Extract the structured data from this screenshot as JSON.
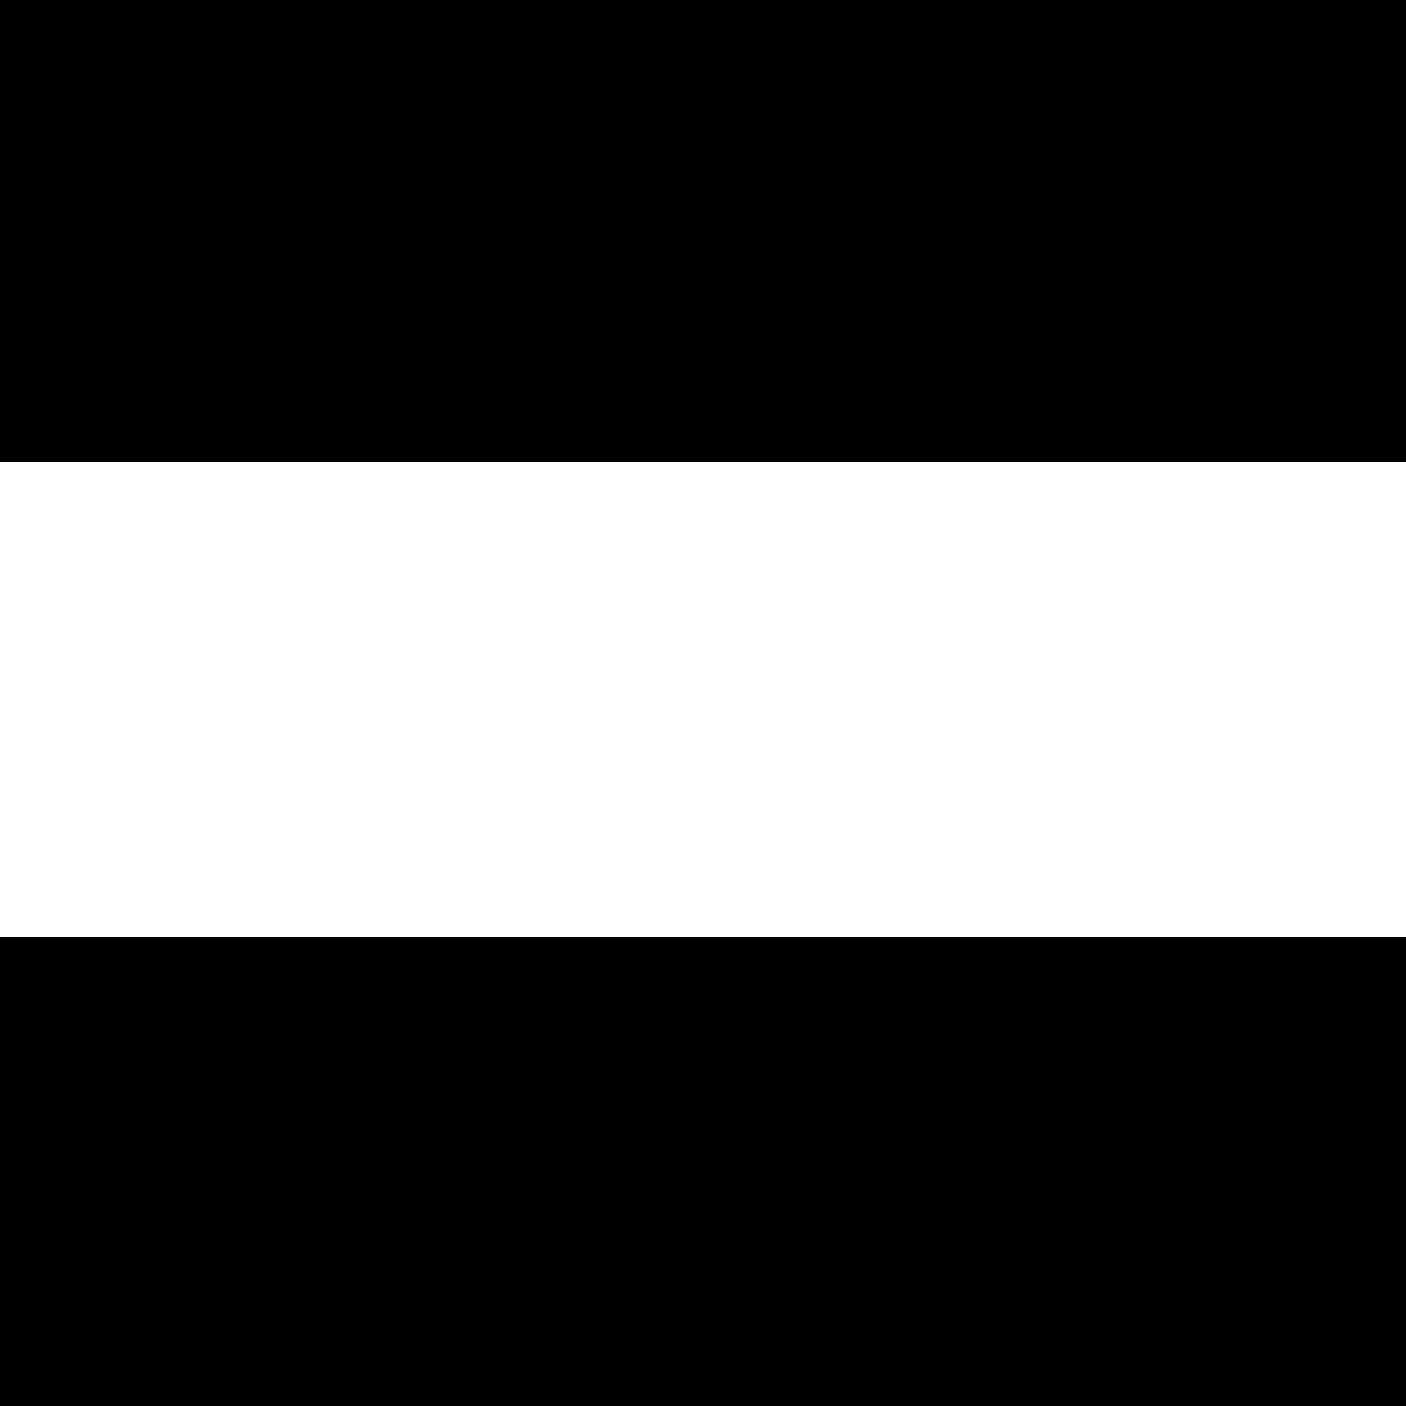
{
  "footnote": "Dimensiones en mm",
  "colors": {
    "letterbox": "#000000",
    "panel_bg": "#ffffff",
    "table_header_bg": "#cccccc",
    "desc_bar_bg": "#cccccc",
    "fridge_strip": "#b3b3b3",
    "line": "#1a1a1a"
  },
  "diagram": {
    "labels": {
      "a": "a",
      "b": "b",
      "c": "c",
      "d": "d",
      "e": "e",
      "f": "f",
      "g": "g",
      "h": "h"
    }
  },
  "table": {
    "header": [
      "Nombre del aparato",
      "a",
      "b",
      "c",
      "d",
      "e",
      "f",
      "g",
      "h"
    ],
    "rows": [
      {
        "name": "KGN 46 (Tirador externo)",
        "values": [
          "1860",
          "700",
          "670",
          "590",
          "740",
          "1310",
          "710",
          "12"
        ]
      },
      {
        "name": "KGN 46 (Tirador integrado)",
        "values": [
          "1860",
          "700",
          "670",
          "590",
          "710",
          "1310",
          "670",
          "12"
        ]
      },
      {
        "name": "KGN 49 (Tirador externo)",
        "values": [
          "2030",
          "700",
          "670",
          "590",
          "740",
          "1310",
          "710",
          "12"
        ]
      },
      {
        "name": "KGN 49 (Tirador integrado)",
        "values": [
          "2030",
          "700",
          "670",
          "590",
          "710",
          "1310",
          "670",
          "12"
        ]
      }
    ]
  },
  "descriptions": {
    "title": "Descripción",
    "items": [
      {
        "key": "a",
        "text": "Altura"
      },
      {
        "key": "b",
        "text": "Anchura"
      },
      {
        "key": "c",
        "text": "Profundidad con la puerta cerrada y sin tirador"
      },
      {
        "key": "d",
        "text": "Profundidad del armario"
      },
      {
        "key": "e",
        "text": "Anchura con la puerta abierta a 90°"
      },
      {
        "key": "f",
        "text": "Profundidad con la puerta abierta y sin tirador"
      },
      {
        "key": "g",
        "text": "Profundidad con la puerta cerrada y con tirador"
      },
      {
        "key": "h",
        "text": "Distancia para el montaje en un nicho o un armario empotrado"
      }
    ]
  }
}
